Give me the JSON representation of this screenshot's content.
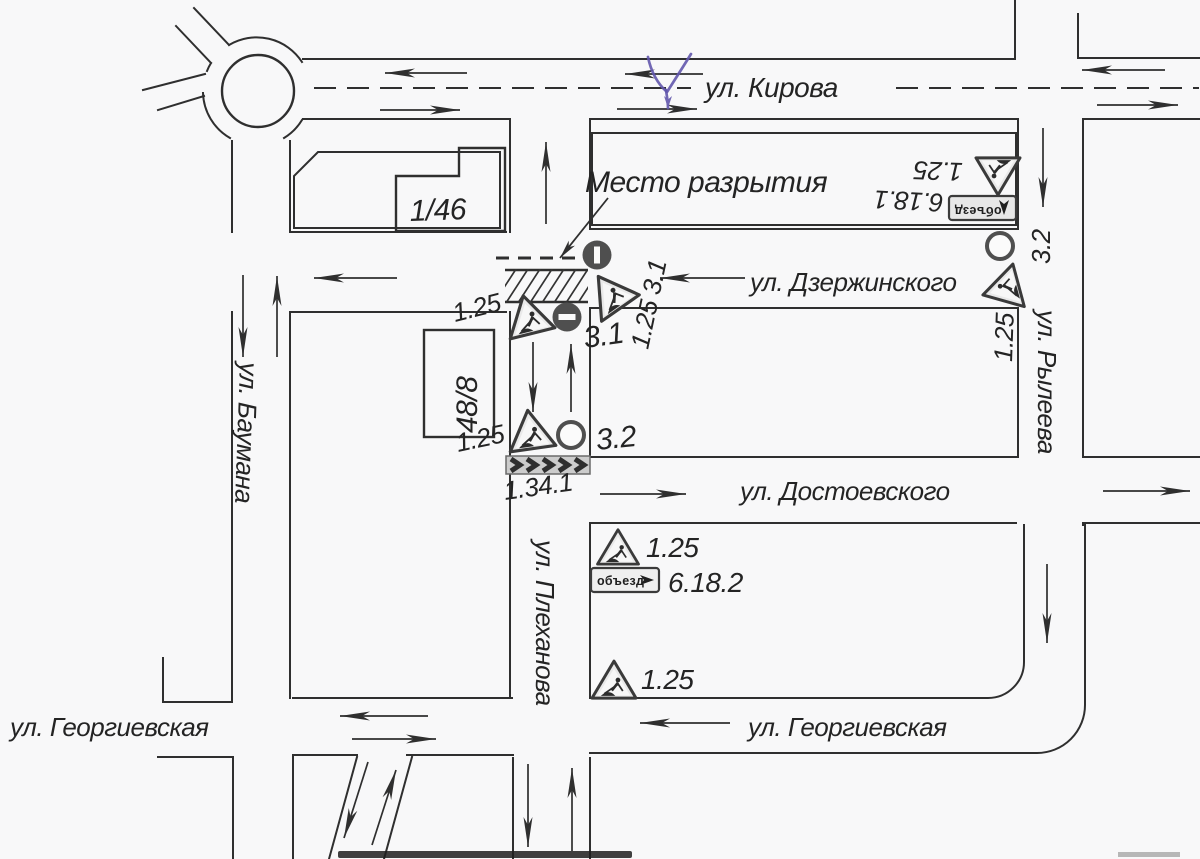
{
  "streets": {
    "kirova": "ул. Кирова",
    "dzerzhinskogo": "ул. Дзержинского",
    "dostoevskogo": "ул. Достоевского",
    "georgievskaya_west": "ул. Георгиевская",
    "georgievskaya_east": "ул. Георгиевская",
    "baumana": "ул. Баумана",
    "plekhanova": "ул. Плеханова",
    "ryleeva": "ул. Рылеева"
  },
  "buildings": {
    "b146": "1/46",
    "b488": "48/8"
  },
  "annotations": {
    "excavation_site": "Место разрытия"
  },
  "signs": {
    "roadworks": "1.25",
    "roadworks_no_entry_combo": "1.25 3.1",
    "no_entry": "3.1",
    "no_vehicles": "3.2",
    "direction_board": "1.34.1",
    "detour_61": "6.18.1",
    "detour_62": "6.18.2",
    "detour_text": "объезд"
  }
}
